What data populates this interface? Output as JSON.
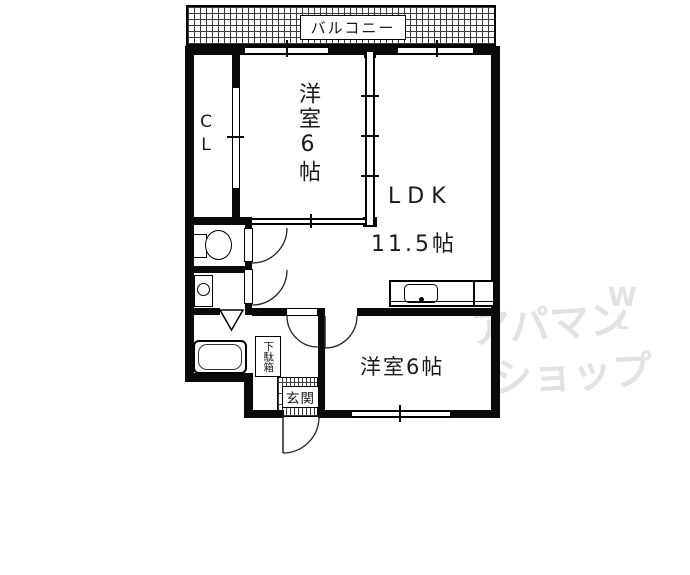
{
  "plan": {
    "balcony": {
      "label": "バルコニー"
    },
    "closet": {
      "label": "CL"
    },
    "bedroom_north": {
      "label": "洋室6帖"
    },
    "ldk": {
      "label": "LDK",
      "size": "11.5帖"
    },
    "bedroom_south": {
      "label": "洋室6帖"
    },
    "shoe_cabinet": {
      "label": "下駄箱"
    },
    "entrance": {
      "label": "玄関"
    }
  },
  "icons": {
    "toilet": "toilet-icon (tank + oval bowl shape)",
    "washing_machine": "washing-machine-icon (square with circle)",
    "bathtub": "bathtub-icon (double rounded rectangle)",
    "bathroom_door": "triangle-door-icon (white triangle pointing down)",
    "kitchen_sink": "kitchen-sink-icon (counter with rounded sink and faucet dot)",
    "door_swing": "quarter-circle-arc"
  },
  "watermark": {
    "line1": "アパマン",
    "mark": "W",
    "mark2": "L",
    "line2": "ショップ",
    "color": "#e2e2e2"
  },
  "colors": {
    "wall": "#0a0a0a",
    "line": "#222222",
    "background": "#ffffff",
    "watermark": "#e2e2e2"
  }
}
